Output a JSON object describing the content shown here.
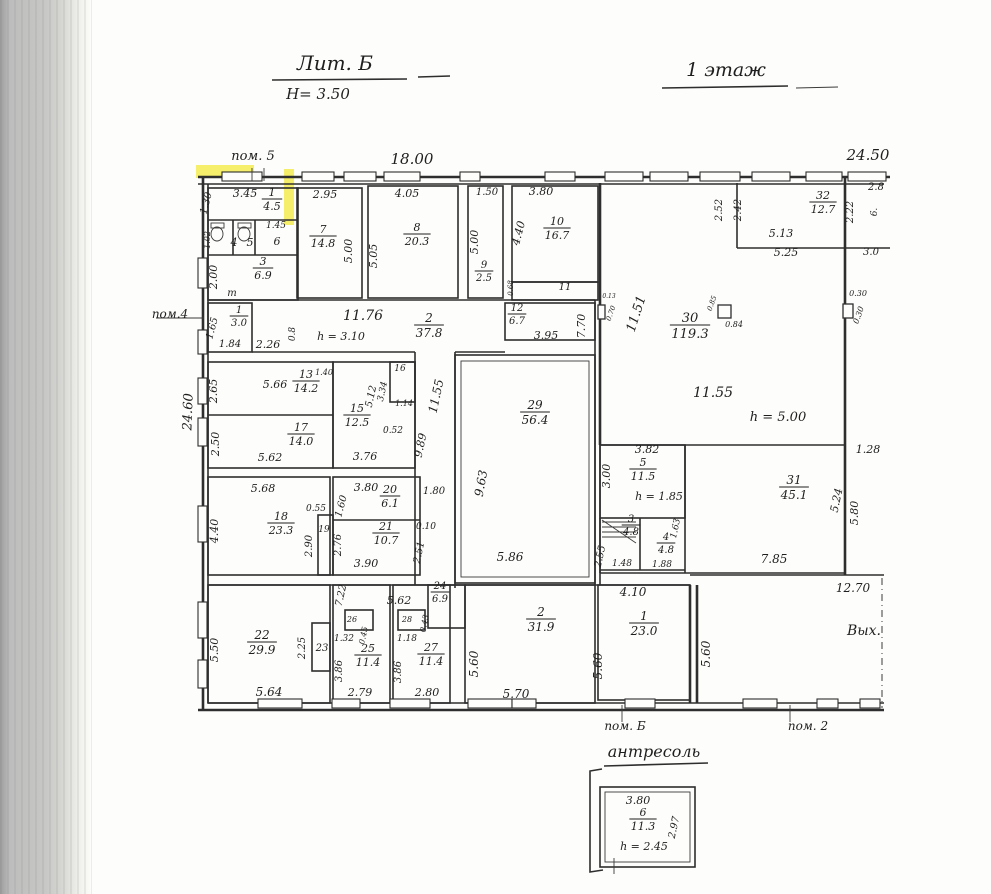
{
  "titles": {
    "building": "Лит. Б",
    "height": "Н= 3.50",
    "floor": "1 этаж",
    "mezzanine": "антресоль"
  },
  "colors": {
    "ink": "#2e2e2e",
    "highlight": "#f2e93b",
    "paper": "#fdfdfb",
    "scan_band": "#c7c7c5"
  },
  "labels": [
    {
      "t": "пом. 5",
      "x": 253,
      "y": 160,
      "s": 13
    },
    {
      "t": "18.00",
      "x": 412,
      "y": 164,
      "s": 15
    },
    {
      "t": "24.50",
      "x": 868,
      "y": 160,
      "s": 15
    },
    {
      "t": "1.30",
      "x": 209,
      "y": 204,
      "r": -75,
      "s": 10
    },
    {
      "t": "3.45",
      "x": 245,
      "y": 197,
      "s": 11
    },
    {
      "f": [
        "1",
        "4.5"
      ],
      "x": 272,
      "y": 199,
      "s": 11
    },
    {
      "t": "1.02",
      "x": 210,
      "y": 240,
      "r": -90,
      "s": 8
    },
    {
      "t": "4",
      "x": 234,
      "y": 246,
      "s": 11
    },
    {
      "t": "5",
      "x": 250,
      "y": 246,
      "s": 11
    },
    {
      "t": "1.45",
      "x": 276,
      "y": 228,
      "s": 9
    },
    {
      "t": "6",
      "x": 277,
      "y": 245,
      "s": 11
    },
    {
      "f": [
        "3",
        "6.9"
      ],
      "x": 263,
      "y": 268,
      "s": 11
    },
    {
      "t": "2.00",
      "x": 217,
      "y": 277,
      "r": -90,
      "s": 11
    },
    {
      "t": "т",
      "x": 232,
      "y": 296,
      "s": 10
    },
    {
      "t": "2.95",
      "x": 325,
      "y": 198,
      "s": 11
    },
    {
      "f": [
        "7",
        "14.8"
      ],
      "x": 323,
      "y": 236,
      "s": 11
    },
    {
      "t": "5.00",
      "x": 352,
      "y": 251,
      "r": -90,
      "s": 11
    },
    {
      "t": "4.05",
      "x": 407,
      "y": 197,
      "s": 11
    },
    {
      "f": [
        "8",
        "20.3"
      ],
      "x": 417,
      "y": 234,
      "s": 11
    },
    {
      "t": "5.05",
      "x": 377,
      "y": 256,
      "r": -90,
      "s": 11
    },
    {
      "t": "1.50",
      "x": 487,
      "y": 195,
      "s": 10
    },
    {
      "t": "5.00",
      "x": 478,
      "y": 242,
      "r": -90,
      "s": 11
    },
    {
      "f": [
        "9",
        "2.5"
      ],
      "x": 484,
      "y": 271,
      "s": 10
    },
    {
      "t": "3.80",
      "x": 541,
      "y": 195,
      "s": 11
    },
    {
      "t": "4.40",
      "x": 522,
      "y": 234,
      "r": -75,
      "s": 11
    },
    {
      "f": [
        "10",
        "16.7"
      ],
      "x": 557,
      "y": 228,
      "s": 11
    },
    {
      "t": "0.68",
      "x": 513,
      "y": 288,
      "r": -90,
      "s": 7
    },
    {
      "t": "11",
      "x": 565,
      "y": 290,
      "s": 10
    },
    {
      "t": "2.52",
      "x": 722,
      "y": 210,
      "r": -90,
      "s": 10
    },
    {
      "t": "2.42",
      "x": 741,
      "y": 210,
      "r": -90,
      "s": 10
    },
    {
      "f": [
        "32",
        "12.7"
      ],
      "x": 823,
      "y": 202,
      "s": 11
    },
    {
      "t": "5.13",
      "x": 781,
      "y": 237,
      "s": 11
    },
    {
      "t": "5.25",
      "x": 786,
      "y": 256,
      "s": 11
    },
    {
      "t": "2.22",
      "x": 853,
      "y": 212,
      "r": -90,
      "s": 10
    },
    {
      "t": "2.8",
      "x": 876,
      "y": 190,
      "s": 10
    },
    {
      "t": "6.",
      "x": 877,
      "y": 212,
      "r": -90,
      "s": 9
    },
    {
      "t": "3.0",
      "x": 871,
      "y": 255,
      "s": 10
    },
    {
      "t": "0.30",
      "x": 858,
      "y": 296,
      "s": 8
    },
    {
      "t": "0.30",
      "x": 861,
      "y": 316,
      "r": -70,
      "s": 8
    },
    {
      "t": "пом.4",
      "x": 170,
      "y": 318,
      "s": 12
    },
    {
      "t": "1.65",
      "x": 215,
      "y": 329,
      "r": -75,
      "s": 10
    },
    {
      "f": [
        "1",
        "3.0"
      ],
      "x": 239,
      "y": 316,
      "s": 10
    },
    {
      "t": "1.84",
      "x": 230,
      "y": 347,
      "s": 10
    },
    {
      "t": "2.26",
      "x": 268,
      "y": 348,
      "s": 11
    },
    {
      "t": "0.8",
      "x": 295,
      "y": 334,
      "r": -90,
      "s": 9
    },
    {
      "t": "11.76",
      "x": 363,
      "y": 320,
      "s": 14
    },
    {
      "t": "h = 3.10",
      "x": 341,
      "y": 340,
      "s": 11
    },
    {
      "f": [
        "2",
        "37.8"
      ],
      "x": 429,
      "y": 325,
      "s": 12
    },
    {
      "f": [
        "12",
        "6.7"
      ],
      "x": 517,
      "y": 314,
      "s": 10
    },
    {
      "t": "3.95",
      "x": 546,
      "y": 339,
      "s": 11
    },
    {
      "t": "7.70",
      "x": 585,
      "y": 326,
      "r": -90,
      "s": 11
    },
    {
      "t": "11.51",
      "x": 640,
      "y": 315,
      "r": -72,
      "s": 13
    },
    {
      "t": "0.13",
      "x": 609,
      "y": 298,
      "s": 6
    },
    {
      "t": "0.70",
      "x": 613,
      "y": 314,
      "r": -70,
      "s": 7
    },
    {
      "f": [
        "30",
        "119.3"
      ],
      "x": 690,
      "y": 325,
      "s": 13
    },
    {
      "t": "0.85",
      "x": 714,
      "y": 304,
      "r": -70,
      "s": 7
    },
    {
      "t": "0.84",
      "x": 734,
      "y": 327,
      "s": 8
    },
    {
      "t": "11.55",
      "x": 713,
      "y": 397,
      "s": 14
    },
    {
      "t": "h = 5.00",
      "x": 778,
      "y": 421,
      "s": 13
    },
    {
      "t": "24.60",
      "x": 192,
      "y": 412,
      "r": -88,
      "s": 13
    },
    {
      "t": "2.65",
      "x": 217,
      "y": 391,
      "r": -90,
      "s": 11
    },
    {
      "t": "5.66",
      "x": 275,
      "y": 388,
      "s": 11
    },
    {
      "f": [
        "13",
        "14.2"
      ],
      "x": 306,
      "y": 381,
      "s": 11
    },
    {
      "t": "1.40",
      "x": 324,
      "y": 375,
      "s": 8
    },
    {
      "t": "5.12",
      "x": 374,
      "y": 397,
      "r": -78,
      "s": 10
    },
    {
      "t": "16",
      "x": 400,
      "y": 371,
      "s": 9
    },
    {
      "t": "3.34",
      "x": 385,
      "y": 392,
      "r": -78,
      "s": 9
    },
    {
      "t": "1.14",
      "x": 404,
      "y": 406,
      "s": 8
    },
    {
      "t": "0.52",
      "x": 393,
      "y": 433,
      "s": 9
    },
    {
      "f": [
        "15",
        "12.5"
      ],
      "x": 357,
      "y": 415,
      "s": 11
    },
    {
      "t": "2.50",
      "x": 219,
      "y": 444,
      "r": -90,
      "s": 11
    },
    {
      "f": [
        "17",
        "14.0"
      ],
      "x": 301,
      "y": 434,
      "s": 11
    },
    {
      "t": "5.62",
      "x": 270,
      "y": 461,
      "s": 11
    },
    {
      "t": "3.76",
      "x": 365,
      "y": 460,
      "s": 11
    },
    {
      "t": "9.89",
      "x": 424,
      "y": 446,
      "r": -78,
      "s": 11
    },
    {
      "t": "11.55",
      "x": 440,
      "y": 397,
      "r": -78,
      "s": 12
    },
    {
      "f": [
        "29",
        "56.4"
      ],
      "x": 535,
      "y": 412,
      "s": 12
    },
    {
      "t": "9.63",
      "x": 485,
      "y": 484,
      "r": -80,
      "s": 12
    },
    {
      "t": "5.86",
      "x": 510,
      "y": 561,
      "s": 12
    },
    {
      "t": "1.80",
      "x": 434,
      "y": 494,
      "s": 10
    },
    {
      "t": "0.10",
      "x": 426,
      "y": 529,
      "s": 9
    },
    {
      "t": "2.51",
      "x": 422,
      "y": 553,
      "r": -78,
      "s": 10
    },
    {
      "t": "5.68",
      "x": 263,
      "y": 492,
      "s": 11
    },
    {
      "t": "4.40",
      "x": 218,
      "y": 531,
      "r": -90,
      "s": 11
    },
    {
      "f": [
        "18",
        "23.3"
      ],
      "x": 281,
      "y": 523,
      "s": 11
    },
    {
      "t": "0.55",
      "x": 316,
      "y": 511,
      "s": 9
    },
    {
      "t": "19",
      "x": 324,
      "y": 532,
      "s": 9
    },
    {
      "t": "2.90",
      "x": 312,
      "y": 546,
      "r": -90,
      "s": 10
    },
    {
      "t": "3.80",
      "x": 366,
      "y": 491,
      "s": 11
    },
    {
      "t": "1.60",
      "x": 344,
      "y": 507,
      "r": -75,
      "s": 10
    },
    {
      "f": [
        "20",
        "6.1"
      ],
      "x": 390,
      "y": 496,
      "s": 11
    },
    {
      "f": [
        "21",
        "10.7"
      ],
      "x": 386,
      "y": 533,
      "s": 11
    },
    {
      "t": "2.76",
      "x": 341,
      "y": 545,
      "r": -90,
      "s": 10
    },
    {
      "t": "3.90",
      "x": 366,
      "y": 567,
      "s": 11
    },
    {
      "t": "3.82",
      "x": 647,
      "y": 453,
      "s": 11
    },
    {
      "t": "3.00",
      "x": 610,
      "y": 476,
      "r": -90,
      "s": 11
    },
    {
      "f": [
        "5",
        "11.5"
      ],
      "x": 643,
      "y": 469,
      "s": 11
    },
    {
      "t": "h = 1.85",
      "x": 659,
      "y": 500,
      "s": 11
    },
    {
      "f": [
        "3",
        "4.8"
      ],
      "x": 631,
      "y": 525,
      "s": 10
    },
    {
      "t": "2.55",
      "x": 603,
      "y": 557,
      "r": -78,
      "s": 10
    },
    {
      "f": [
        "4",
        "4.8"
      ],
      "x": 666,
      "y": 543,
      "s": 10
    },
    {
      "t": "1.63",
      "x": 678,
      "y": 529,
      "r": -78,
      "s": 9
    },
    {
      "t": "1.48",
      "x": 622,
      "y": 566,
      "s": 9
    },
    {
      "t": "1.88",
      "x": 662,
      "y": 567,
      "s": 9
    },
    {
      "f": [
        "31",
        "45.1"
      ],
      "x": 794,
      "y": 487,
      "s": 12
    },
    {
      "t": "5.24",
      "x": 840,
      "y": 501,
      "r": -78,
      "s": 11
    },
    {
      "t": "5.80",
      "x": 858,
      "y": 513,
      "r": -90,
      "s": 11
    },
    {
      "t": "1.28",
      "x": 868,
      "y": 453,
      "s": 11
    },
    {
      "t": "7.85",
      "x": 774,
      "y": 563,
      "s": 12
    },
    {
      "t": "12.70",
      "x": 853,
      "y": 592,
      "s": 12
    },
    {
      "t": "7.22",
      "x": 344,
      "y": 596,
      "r": -78,
      "s": 10
    },
    {
      "t": "5.62",
      "x": 399,
      "y": 604,
      "s": 11
    },
    {
      "f": [
        "24",
        "6.9"
      ],
      "x": 440,
      "y": 592,
      "s": 10
    },
    {
      "t": "0.43",
      "x": 427,
      "y": 624,
      "r": -78,
      "s": 8
    },
    {
      "t": "5.50",
      "x": 218,
      "y": 650,
      "r": -90,
      "s": 11
    },
    {
      "f": [
        "22",
        "29.9"
      ],
      "x": 262,
      "y": 642,
      "s": 12
    },
    {
      "t": "5.64",
      "x": 269,
      "y": 696,
      "s": 12
    },
    {
      "t": "2.25",
      "x": 305,
      "y": 648,
      "r": -90,
      "s": 10
    },
    {
      "t": "23",
      "x": 322,
      "y": 651,
      "s": 10
    },
    {
      "t": "1.32",
      "x": 344,
      "y": 641,
      "s": 9
    },
    {
      "t": "26",
      "x": 352,
      "y": 622,
      "s": 8
    },
    {
      "t": "0.45",
      "x": 366,
      "y": 636,
      "r": -78,
      "s": 8
    },
    {
      "f": [
        "25",
        "11.4"
      ],
      "x": 368,
      "y": 655,
      "s": 11
    },
    {
      "t": "3.86",
      "x": 342,
      "y": 671,
      "r": -90,
      "s": 10
    },
    {
      "t": "2.79",
      "x": 360,
      "y": 696,
      "s": 11
    },
    {
      "t": "1.18",
      "x": 407,
      "y": 641,
      "s": 9
    },
    {
      "t": "28",
      "x": 407,
      "y": 622,
      "s": 8
    },
    {
      "f": [
        "27",
        "11.4"
      ],
      "x": 431,
      "y": 654,
      "s": 11
    },
    {
      "t": "3.86",
      "x": 401,
      "y": 672,
      "r": -90,
      "s": 10
    },
    {
      "t": "2.80",
      "x": 427,
      "y": 696,
      "s": 11
    },
    {
      "f": [
        "2",
        "31.9"
      ],
      "x": 541,
      "y": 619,
      "s": 12
    },
    {
      "t": "5.60",
      "x": 478,
      "y": 664,
      "r": -90,
      "s": 12
    },
    {
      "t": "5.70",
      "x": 516,
      "y": 698,
      "s": 12
    },
    {
      "t": "4.10",
      "x": 633,
      "y": 596,
      "s": 12
    },
    {
      "f": [
        "1",
        "23.0"
      ],
      "x": 644,
      "y": 623,
      "s": 12
    },
    {
      "t": "5.60",
      "x": 602,
      "y": 666,
      "r": -90,
      "s": 12
    },
    {
      "t": "5.60",
      "x": 710,
      "y": 654,
      "r": -90,
      "s": 12
    },
    {
      "t": "Вых.",
      "x": 864,
      "y": 635,
      "s": 14
    },
    {
      "t": "пом. Б",
      "x": 625,
      "y": 730,
      "s": 12
    },
    {
      "t": "пом. 2",
      "x": 808,
      "y": 730,
      "s": 12
    },
    {
      "t": "3.80",
      "x": 638,
      "y": 804,
      "s": 11
    },
    {
      "f": [
        "6",
        "11.3"
      ],
      "x": 643,
      "y": 819,
      "s": 11
    },
    {
      "t": "h = 2.45",
      "x": 644,
      "y": 850,
      "s": 11
    },
    {
      "t": "2.97",
      "x": 677,
      "y": 828,
      "r": -78,
      "s": 10
    }
  ]
}
